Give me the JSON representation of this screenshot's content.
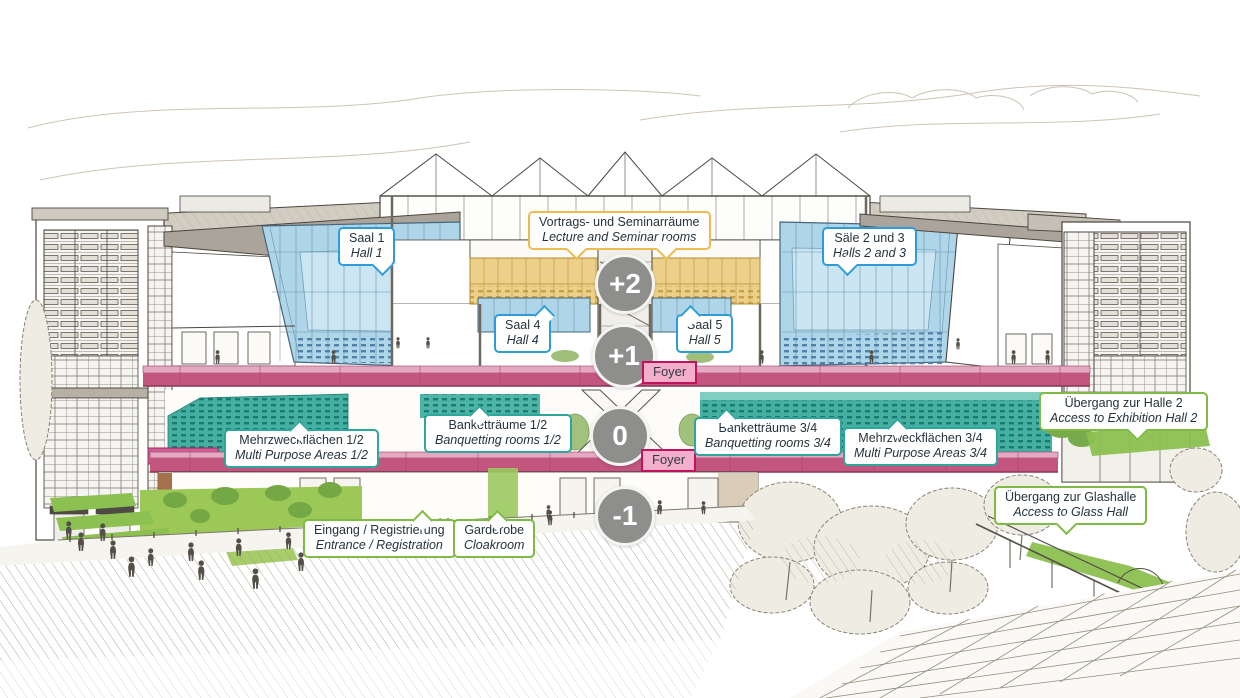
{
  "diagram": {
    "description": "Architectural cross-section of congress centre with level and room annotations",
    "levels": [
      {
        "label": "+2"
      },
      {
        "label": "+1"
      },
      {
        "label": "0"
      },
      {
        "label": "-1"
      }
    ],
    "foyer_labels": [
      {
        "label": "Foyer"
      },
      {
        "label": "Foyer"
      }
    ],
    "callouts": {
      "seminar_rooms": {
        "de": "Vortrags- und Seminarräume",
        "en": "Lecture and Seminar rooms"
      },
      "hall_1": {
        "de": "Saal 1",
        "en": "Hall 1"
      },
      "halls_2_3": {
        "de": "Säle 2 und 3",
        "en": "Halls 2 and 3"
      },
      "hall_4": {
        "de": "Saal 4",
        "en": "Hall 4"
      },
      "hall_5": {
        "de": "Saal 5",
        "en": "Hall 5"
      },
      "banquet_12": {
        "de": "Banketträume 1/2",
        "en": "Banquetting rooms 1/2"
      },
      "banquet_34": {
        "de": "Banketträume 3/4",
        "en": "Banquetting rooms 3/4"
      },
      "multi_purpose_12": {
        "de": "Mehrzweckflächen 1/2",
        "en": "Multi Purpose Areas 1/2"
      },
      "multi_purpose_34": {
        "de": "Mehrzweckflächen 3/4",
        "en": "Multi Purpose Areas 3/4"
      },
      "exhibition_hall_2": {
        "de": "Übergang zur Halle 2",
        "en": "Access to Exhibition Hall 2"
      },
      "glass_hall": {
        "de": "Übergang zur Glashalle",
        "en": "Access to Glass Hall"
      },
      "entrance": {
        "de": "Eingang / Registrierung",
        "en": "Entrance / Registration"
      },
      "cloakroom": {
        "de": "Garderobe",
        "en": "Cloakroom"
      }
    },
    "colors": {
      "callout_blue": "#2f9cd8",
      "callout_yellow": "#eebc4e",
      "callout_teal": "#2fa69b",
      "callout_green": "#7eba45",
      "hall_glass_blue": "#aed6e8",
      "seminar_yellow": "#ecd08a",
      "multipurpose_teal": "#45b0a2",
      "foyer_band_pink": "#c2567e",
      "foyer_label_bg": "#f3aeca",
      "foyer_label_border": "#c2125e",
      "access_green": "#8cc050",
      "level_badge_gray": "#8e8e8c"
    }
  }
}
